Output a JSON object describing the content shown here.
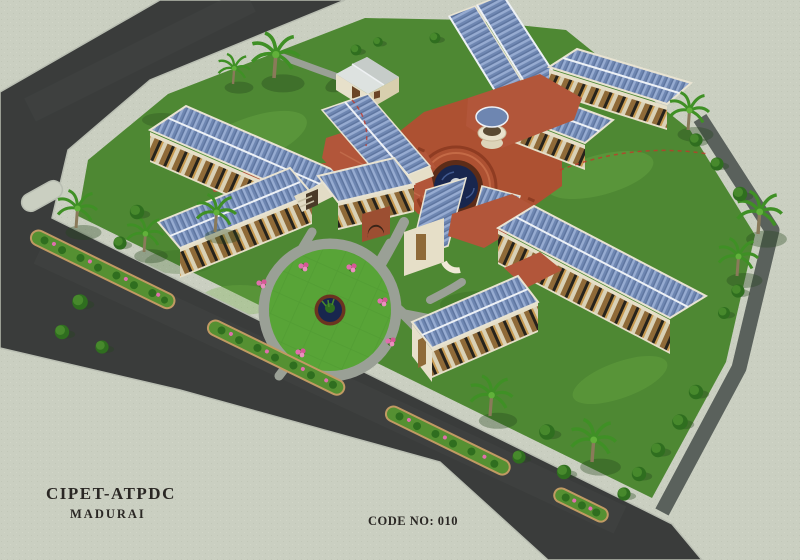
{
  "scene": {
    "type": "aerial architectural rendering",
    "description": "Bird's-eye 3D render of the CIPET-ATPDC campus: radial academic wings with blue corrugated roofs and red link corridors around a central terracotta fountain plaza, a circular garden with pond, perimeter asphalt roads with hedge median planters, palm trees and shrubs on lawns, surrounded by light concrete ground.",
    "landmarks": [
      "perimeter road",
      "boulevard with median planters",
      "service road",
      "campus lawn",
      "central fountain plaza",
      "round balcony tower",
      "circular garden with pond",
      "academic wings with blue metal roofs",
      "red-roofed link corridors",
      "arched gateway",
      "white utility building",
      "palm trees",
      "shrubs",
      "flower beds"
    ]
  },
  "title_block": {
    "line1": "CIPET-ATPDC",
    "line2": "MADURAI"
  },
  "code_label": "CODE NO: 010",
  "palette": {
    "concrete": "#cacfc1",
    "asphalt": "#3a3c3b",
    "service_road": "#5a615c",
    "lawn": "#4e8833",
    "garden_lawn": "#58a437",
    "roof_blue": "#6e86b1",
    "roof_ridge_white": "#edf1f6",
    "roof_red": "#b2563a",
    "wall_cream": "#e6dfc8",
    "window_brown": "#8f6a38",
    "plaza_terracotta": "#ad5132",
    "fountain_water": "#18264e",
    "path_gray": "#9aa096",
    "hedge_green": "#3e7d26",
    "flower_pink": "#e06fae",
    "planter_curb": "#c19a63",
    "text_dark": "#2a2724"
  }
}
